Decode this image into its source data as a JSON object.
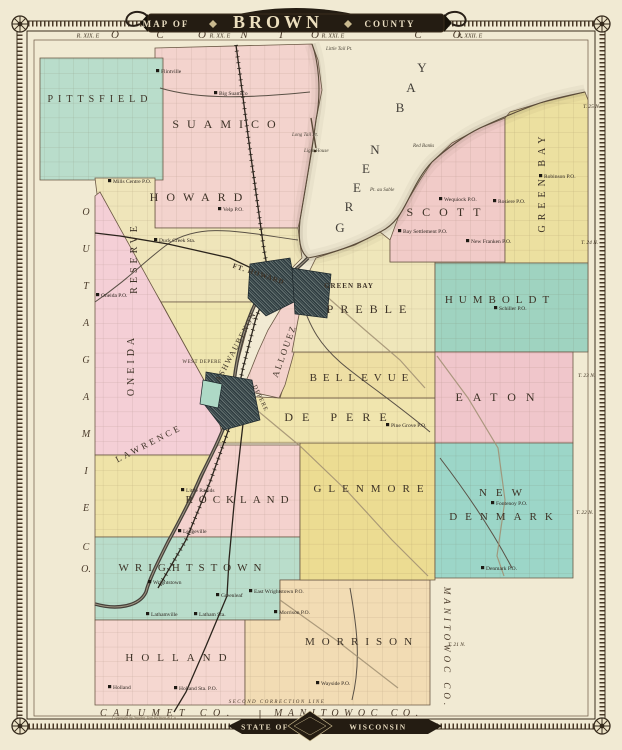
{
  "title": {
    "map_of": "MAP OF",
    "name": "BROWN",
    "county": "COUNTY"
  },
  "footer": {
    "state_of": "STATE OF",
    "wisconsin": "WISCONSIN",
    "imprint": "Copyright by Snyder, Van Vechten & Co.",
    "correction_line": "SECOND CORRECTION LINE"
  },
  "edge": {
    "top_letters": [
      {
        "t": "O",
        "x": 115
      },
      {
        "t": "C",
        "x": 160
      },
      {
        "t": "O",
        "x": 202
      },
      {
        "t": "N",
        "x": 244
      },
      {
        "t": "T",
        "x": 281
      },
      {
        "t": "O",
        "x": 315
      },
      {
        "t": "C",
        "x": 418
      },
      {
        "t": "O.",
        "x": 458
      }
    ],
    "top_ranges": [
      {
        "t": "R. XIX. E",
        "x": 88
      },
      {
        "t": "R. XX. E",
        "x": 220
      },
      {
        "t": "R. XXI. E",
        "x": 333
      },
      {
        "t": "R. XXII. E",
        "x": 470
      }
    ],
    "left_letters": [
      {
        "t": "O",
        "y": 215
      },
      {
        "t": "U",
        "y": 252
      },
      {
        "t": "T",
        "y": 289
      },
      {
        "t": "A",
        "y": 326
      },
      {
        "t": "G",
        "y": 363
      },
      {
        "t": "A",
        "y": 400
      },
      {
        "t": "M",
        "y": 437
      },
      {
        "t": "I",
        "y": 474
      },
      {
        "t": "E",
        "y": 511
      },
      {
        "t": "C",
        "y": 550
      },
      {
        "t": "O.",
        "y": 572
      }
    ],
    "bottom_words": [
      {
        "t": "CALUMET CO.",
        "x": 100,
        "ls": 6.5
      },
      {
        "t": "MANITOWOC CO.",
        "x": 274,
        "ls": 5.5
      }
    ],
    "right_vertical": "MANITOWOC CO.",
    "right_townships": [
      {
        "t": "T. 25 N.",
        "x": 583,
        "y": 108
      },
      {
        "t": "T. 24 N.",
        "x": 581,
        "y": 244
      },
      {
        "t": "T. 23 N.",
        "x": 578,
        "y": 377
      },
      {
        "t": "T. 22 N.",
        "x": 576,
        "y": 514
      },
      {
        "t": "T. 21 N.",
        "x": 448,
        "y": 646
      }
    ]
  },
  "water": {
    "name": "GREEN BAY",
    "letters": [
      {
        "t": "G",
        "x": 340,
        "y": 232
      },
      {
        "t": "R",
        "x": 349,
        "y": 211
      },
      {
        "t": "E",
        "x": 357,
        "y": 192
      },
      {
        "t": "E",
        "x": 366,
        "y": 173
      },
      {
        "t": "N",
        "x": 375,
        "y": 154
      },
      {
        "t": "B",
        "x": 400,
        "y": 112
      },
      {
        "t": "A",
        "x": 411,
        "y": 92
      },
      {
        "t": "Y",
        "x": 422,
        "y": 72
      }
    ],
    "shore_labels": [
      {
        "t": "Little Tail Pt.",
        "x": 326,
        "y": 50
      },
      {
        "t": "Long Tail Pt.",
        "x": 292,
        "y": 136
      },
      {
        "t": "Light House",
        "x": 304,
        "y": 152
      },
      {
        "t": "Red Banks",
        "x": 413,
        "y": 147
      },
      {
        "t": "Pt. au Sable",
        "x": 370,
        "y": 191
      }
    ]
  },
  "map": {
    "regions": [
      {
        "name": "suamico",
        "color": "#f3d3cd",
        "points": "155,48 312,44 318,60 322,90 316,120 312,150 306,185 300,220 298,228 155,228"
      },
      {
        "name": "pittsfield",
        "color": "#b9ddcb",
        "points": "40,58 163,58 163,180 40,180"
      },
      {
        "name": "howard",
        "color": "#efe5ba",
        "points": "95,178 155,178 155,228 298,228 302,258 288,272 270,290 256,302 161,302 97,194"
      },
      {
        "name": "oneida-reserve",
        "color": "#f4cfd6",
        "points": "95,196 100,192 215,400 222,435 212,455 95,455"
      },
      {
        "name": "ashwaubenon",
        "color": "#efe6b0",
        "points": "161,302 256,302 248,325 240,355 234,380 226,395 215,400"
      },
      {
        "name": "lawrence",
        "color": "#efe3a8",
        "points": "95,455 212,455 202,478 193,498 180,522 170,537 95,537"
      },
      {
        "name": "rockland",
        "color": "#f4d2ce",
        "points": "218,445 300,445 300,537 172,537 181,520 193,498 202,478 212,455"
      },
      {
        "name": "wrightstown",
        "color": "#b9ddcb",
        "points": "95,537 300,537 300,580 280,580 280,620 95,620"
      },
      {
        "name": "holland",
        "color": "#f5d7d0",
        "points": "95,620 245,620 245,705 95,705"
      },
      {
        "name": "morrison",
        "color": "#f2dcb4",
        "points": "245,620 280,620 280,580 430,580 430,705 245,705"
      },
      {
        "name": "glenmore",
        "color": "#ecdc92",
        "points": "300,443 435,443 435,580 300,580"
      },
      {
        "name": "depere-township",
        "color": "#f0e5ae",
        "points": "236,396 280,398 435,398 435,443 218,443 222,428 230,410"
      },
      {
        "name": "bellevue",
        "color": "#eedfa4",
        "points": "292,352 435,352 435,398 280,398 284,385 288,368"
      },
      {
        "name": "allouez",
        "color": "#f3d2cc",
        "points": "296,292 310,300 300,330 292,360 285,385 279,398 242,390 250,372 258,352 268,330 280,310"
      },
      {
        "name": "preble",
        "color": "#efe6ba",
        "points": "316,258 355,245 380,232 390,240 390,262 435,262 435,352 292,352 298,320 304,290 310,270"
      },
      {
        "name": "scott",
        "color": "#f1cbc8",
        "points": "398,218 408,200 420,180 432,162 452,143 480,128 505,118 505,262 390,262 390,240"
      },
      {
        "name": "green-bay-township",
        "color": "#ece0a0",
        "points": "505,118 510,112 540,103 585,92 588,100 588,263 505,263"
      },
      {
        "name": "humboldt",
        "color": "#9fd3c0",
        "points": "435,263 588,263 588,352 435,352"
      },
      {
        "name": "eaton",
        "color": "#f0c6cb",
        "points": "435,352 573,352 573,443 435,443"
      },
      {
        "name": "new-denmark",
        "color": "#9cd6c8",
        "points": "435,443 573,443 573,578 435,578"
      }
    ],
    "labels": [
      {
        "t": "PITTSFIELD",
        "x": 100,
        "y": 102,
        "s": 10,
        "ls": 5
      },
      {
        "t": "SUAMICO",
        "x": 228,
        "y": 128,
        "s": 12,
        "ls": 8
      },
      {
        "t": "HOWARD",
        "x": 200,
        "y": 201,
        "s": 12,
        "ls": 8
      },
      {
        "t": "SCOTT",
        "x": 448,
        "y": 216,
        "s": 12,
        "ls": 9
      },
      {
        "t": "GREEN BAY",
        "x": 545,
        "y": 182,
        "s": 10,
        "ls": 5,
        "r": -90
      },
      {
        "t": "HUMBOLDT",
        "x": 500,
        "y": 303,
        "s": 11,
        "ls": 6
      },
      {
        "t": "PREBLE",
        "x": 370,
        "y": 313,
        "s": 12,
        "ls": 7
      },
      {
        "t": "BELLEVUE",
        "x": 362,
        "y": 381,
        "s": 11,
        "ls": 6
      },
      {
        "t": "ALLOUEZ",
        "x": 287,
        "y": 352,
        "s": 9,
        "ls": 2,
        "r": -70
      },
      {
        "t": "ASHWAUBENON",
        "x": 238,
        "y": 348,
        "s": 8,
        "ls": 1.5,
        "r": -62
      },
      {
        "t": "DE PERE",
        "x": 340,
        "y": 421,
        "s": 12,
        "ls": 9
      },
      {
        "t": "EATON",
        "x": 500,
        "y": 401,
        "s": 12,
        "ls": 10
      },
      {
        "t": "NEW",
        "x": 505,
        "y": 496,
        "s": 11,
        "ls": 9
      },
      {
        "t": "DENMARK",
        "x": 505,
        "y": 520,
        "s": 11,
        "ls": 8
      },
      {
        "t": "GLENMORE",
        "x": 372,
        "y": 492,
        "s": 11,
        "ls": 7
      },
      {
        "t": "ROCKLAND",
        "x": 240,
        "y": 503,
        "s": 11,
        "ls": 6
      },
      {
        "t": "WRIGHTSTOWN",
        "x": 193,
        "y": 571,
        "s": 11,
        "ls": 6
      },
      {
        "t": "HOLLAND",
        "x": 180,
        "y": 661,
        "s": 11,
        "ls": 8
      },
      {
        "t": "MORRISON",
        "x": 362,
        "y": 645,
        "s": 11,
        "ls": 7
      },
      {
        "t": "LAWRENCE",
        "x": 150,
        "y": 446,
        "s": 9,
        "ls": 3,
        "r": -27
      },
      {
        "t": "ONEIDA",
        "x": 134,
        "y": 365,
        "s": 10,
        "ls": 4,
        "r": -90
      },
      {
        "t": "RESERVE",
        "x": 137,
        "y": 258,
        "s": 10,
        "ls": 4,
        "r": -90
      },
      {
        "t": "FT. HOWARD",
        "x": 258,
        "y": 276,
        "s": 7,
        "ls": 1,
        "r": 18,
        "b": 1
      },
      {
        "t": "GREEN BAY",
        "x": 349,
        "y": 288,
        "s": 7,
        "ls": 1,
        "b": 1
      },
      {
        "t": "WEST DEPERE",
        "x": 202,
        "y": 363,
        "s": 5,
        "ls": 0.5
      },
      {
        "t": "DEPERE",
        "x": 259,
        "y": 399,
        "s": 6,
        "ls": 1,
        "r": 65
      }
    ],
    "places": [
      {
        "t": "Flintville",
        "x": 160,
        "y": 73
      },
      {
        "t": "Big Suamico",
        "x": 218,
        "y": 95
      },
      {
        "t": "Mills Centre P.O.",
        "x": 112,
        "y": 183
      },
      {
        "t": "Velp P.O.",
        "x": 222,
        "y": 211
      },
      {
        "t": "Duck Creek Sta.",
        "x": 158,
        "y": 242
      },
      {
        "t": "Oneida P.O.",
        "x": 100,
        "y": 297
      },
      {
        "t": "Pine Grove P.O.",
        "x": 390,
        "y": 427
      },
      {
        "t": "Little Rapids",
        "x": 185,
        "y": 492
      },
      {
        "t": "Ledgeville",
        "x": 182,
        "y": 533
      },
      {
        "t": "Wrightstown",
        "x": 152,
        "y": 584
      },
      {
        "t": "Greenleaf",
        "x": 220,
        "y": 597
      },
      {
        "t": "Lathamville",
        "x": 150,
        "y": 616
      },
      {
        "t": "Latham Sta.",
        "x": 198,
        "y": 616
      },
      {
        "t": "East Wrightstown P.O.",
        "x": 253,
        "y": 593
      },
      {
        "t": "Morrison P.O.",
        "x": 278,
        "y": 614
      },
      {
        "t": "Holland",
        "x": 112,
        "y": 689
      },
      {
        "t": "Holland Sta. P.O.",
        "x": 178,
        "y": 690
      },
      {
        "t": "Wayside P.O.",
        "x": 320,
        "y": 685
      },
      {
        "t": "Denmark P.O.",
        "x": 485,
        "y": 570
      },
      {
        "t": "Fontenoy P.O.",
        "x": 495,
        "y": 505
      },
      {
        "t": "Robinson P.O.",
        "x": 543,
        "y": 178
      },
      {
        "t": "Wequiock P.O.",
        "x": 443,
        "y": 201
      },
      {
        "t": "Rosiere P.O.",
        "x": 497,
        "y": 203
      },
      {
        "t": "Bay Settlement P.O.",
        "x": 402,
        "y": 233
      },
      {
        "t": "New Franken P.O.",
        "x": 470,
        "y": 243
      },
      {
        "t": "Schiller P.O.",
        "x": 498,
        "y": 310
      }
    ]
  }
}
